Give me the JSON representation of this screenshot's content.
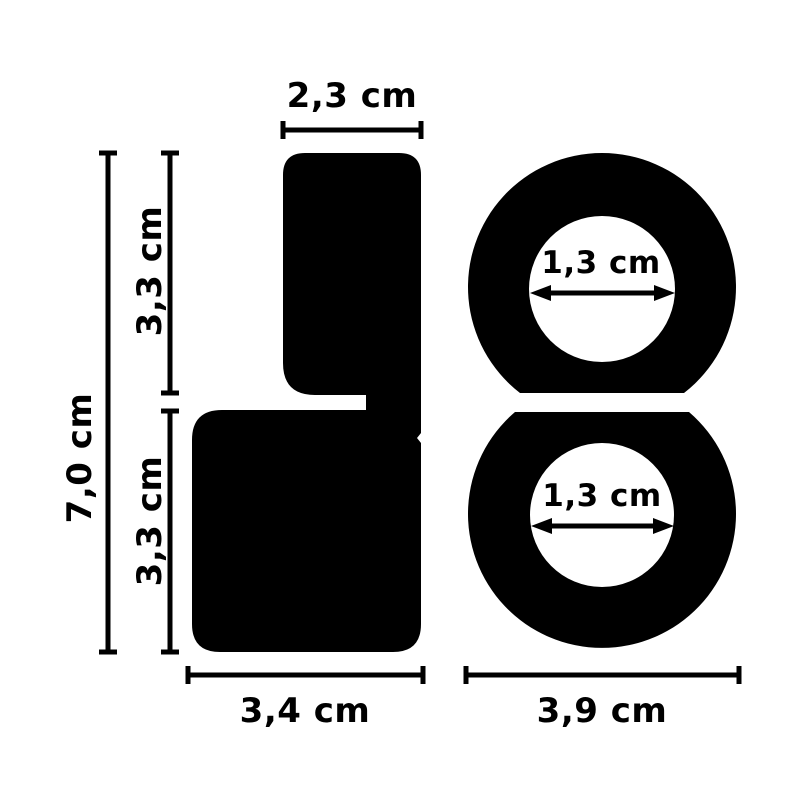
{
  "page": {
    "background_color": "#ffffff",
    "ink_color": "#000000",
    "unit": "cm"
  },
  "side_view": {
    "top_width": {
      "label": "2,3 cm",
      "value_cm": 2.3
    },
    "total_height": {
      "label": "7,0 cm",
      "value_cm": 7.0
    },
    "upper_height": {
      "label": "3,3 cm",
      "value_cm": 3.3
    },
    "lower_height": {
      "label": "3,3 cm",
      "value_cm": 3.3
    },
    "base_width": {
      "label": "3,4 cm",
      "value_cm": 3.4
    }
  },
  "front_view": {
    "top_ring_inner_diameter": {
      "label": "1,3 cm",
      "value_cm": 1.3
    },
    "bottom_ring_inner_diameter": {
      "label": "1,3 cm",
      "value_cm": 1.3
    },
    "outer_width": {
      "label": "3,9 cm",
      "value_cm": 3.9
    }
  }
}
